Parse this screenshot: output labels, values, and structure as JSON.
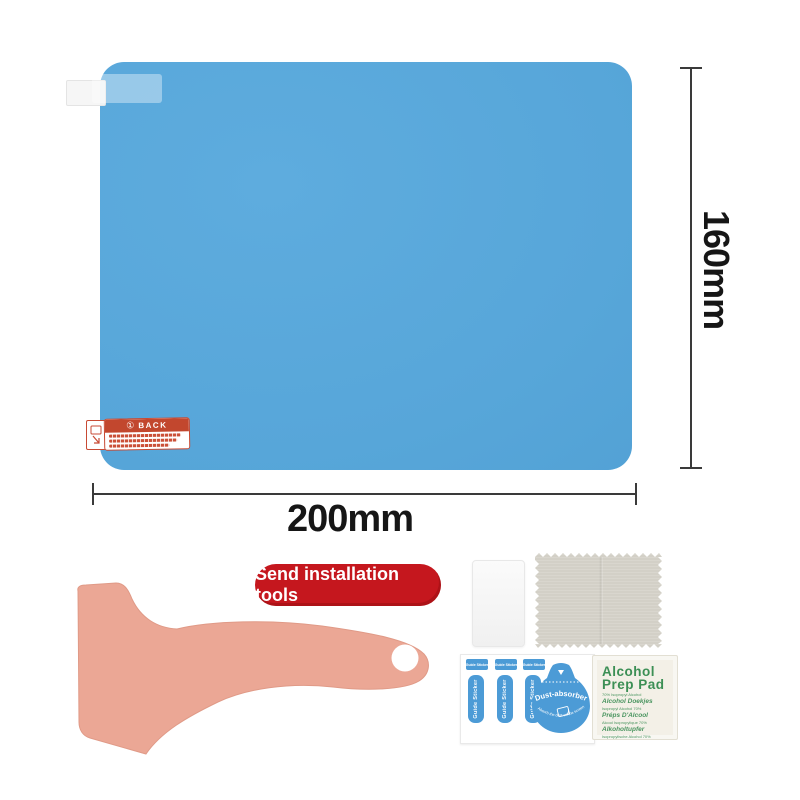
{
  "colors": {
    "film_blue": "#57A6D9",
    "badge_red": "#C5171E",
    "squeegee_pink": "#EBA795",
    "sticker_blue": "#4C9BD6",
    "pad_green": "#3C8F55",
    "cloth_gray": "#D7D4CB",
    "back_sticker_red": "#C2472E",
    "dimension_text": "#161616"
  },
  "film": {
    "back_sticker": {
      "number": "①",
      "label": "BACK"
    }
  },
  "dimensions": {
    "height_label": "160mm",
    "width_label": "200mm"
  },
  "badge": {
    "label": "Send installation tools"
  },
  "tools": {
    "sticker_sheet": {
      "guide_sticker_label": "Guide Sticker",
      "dust_absorber_label": "Dust-absorber",
      "dust_absorber_note": "Absorb the dust on the screen"
    },
    "alcohol_pad": {
      "title1": "Alcohol",
      "title2": "Prep Pad",
      "lines": [
        {
          "style": "tiny",
          "text": "70% Isopropyl Alcohol"
        },
        {
          "style": "bold",
          "text": "Alcohol Doekjes"
        },
        {
          "style": "tiny",
          "text": "Isopropyl Alcohol 70%"
        },
        {
          "style": "bold",
          "text": "Préps D'Alcool"
        },
        {
          "style": "tiny",
          "text": "Alcool Isopropylique 70%"
        },
        {
          "style": "bold",
          "text": "Alkoholtupfer"
        },
        {
          "style": "tiny",
          "text": "Isopropylische Alcohol 70%"
        }
      ]
    }
  }
}
